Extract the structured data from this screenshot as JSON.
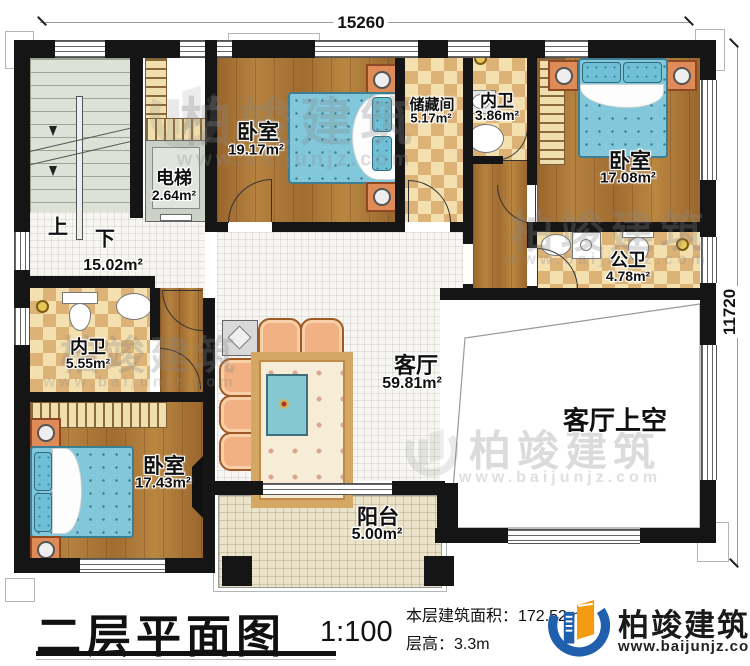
{
  "dimensions": {
    "top": "15260",
    "right": "11720"
  },
  "rooms": {
    "bedroom_top": {
      "name": "卧室",
      "area": "19.17m²"
    },
    "storage": {
      "name": "储藏间",
      "area": "5.17m²"
    },
    "bath_top": {
      "name": "内卫",
      "area": "3.86m²"
    },
    "bedroom_right": {
      "name": "卧室",
      "area": "17.08m²"
    },
    "elevator": {
      "name": "电梯",
      "area": "2.64m²"
    },
    "hall": {
      "area": "15.02m²",
      "up": "上",
      "down": "下"
    },
    "public_bath": {
      "name": "公卫",
      "area": "4.78m²"
    },
    "bath_left": {
      "name": "内卫",
      "area": "5.55m²"
    },
    "living": {
      "name": "客厅",
      "area": "59.81m²"
    },
    "void": {
      "name": "客厅上空"
    },
    "bedroom_bottom": {
      "name": "卧室",
      "area": "17.43m²"
    },
    "balcony": {
      "name": "阳台",
      "area": "5.00m²"
    }
  },
  "titleblock": {
    "title": "二层平面图",
    "scale": "1:100",
    "area_line": "本层建筑面积：172.52m²",
    "height_line": "层高：3.3m"
  },
  "brand": {
    "name": "柏竣建筑",
    "url": "www.baijunjz.com"
  },
  "watermark": {
    "name": "柏竣建筑",
    "url": "www.baijunjz.com"
  },
  "colors": {
    "wall": "#151515",
    "wood": "#a9743a",
    "checker_light": "#f4dfae",
    "checker_dark": "#dcb277",
    "stair": "#dce2d5",
    "balcony": "#ebe4ca",
    "bed_blue": "#82c7da",
    "nightstand": "#df8b57",
    "sofa": "#f1b183",
    "brand_blue": "#1f5fae",
    "brand_orange": "#f39c12"
  }
}
